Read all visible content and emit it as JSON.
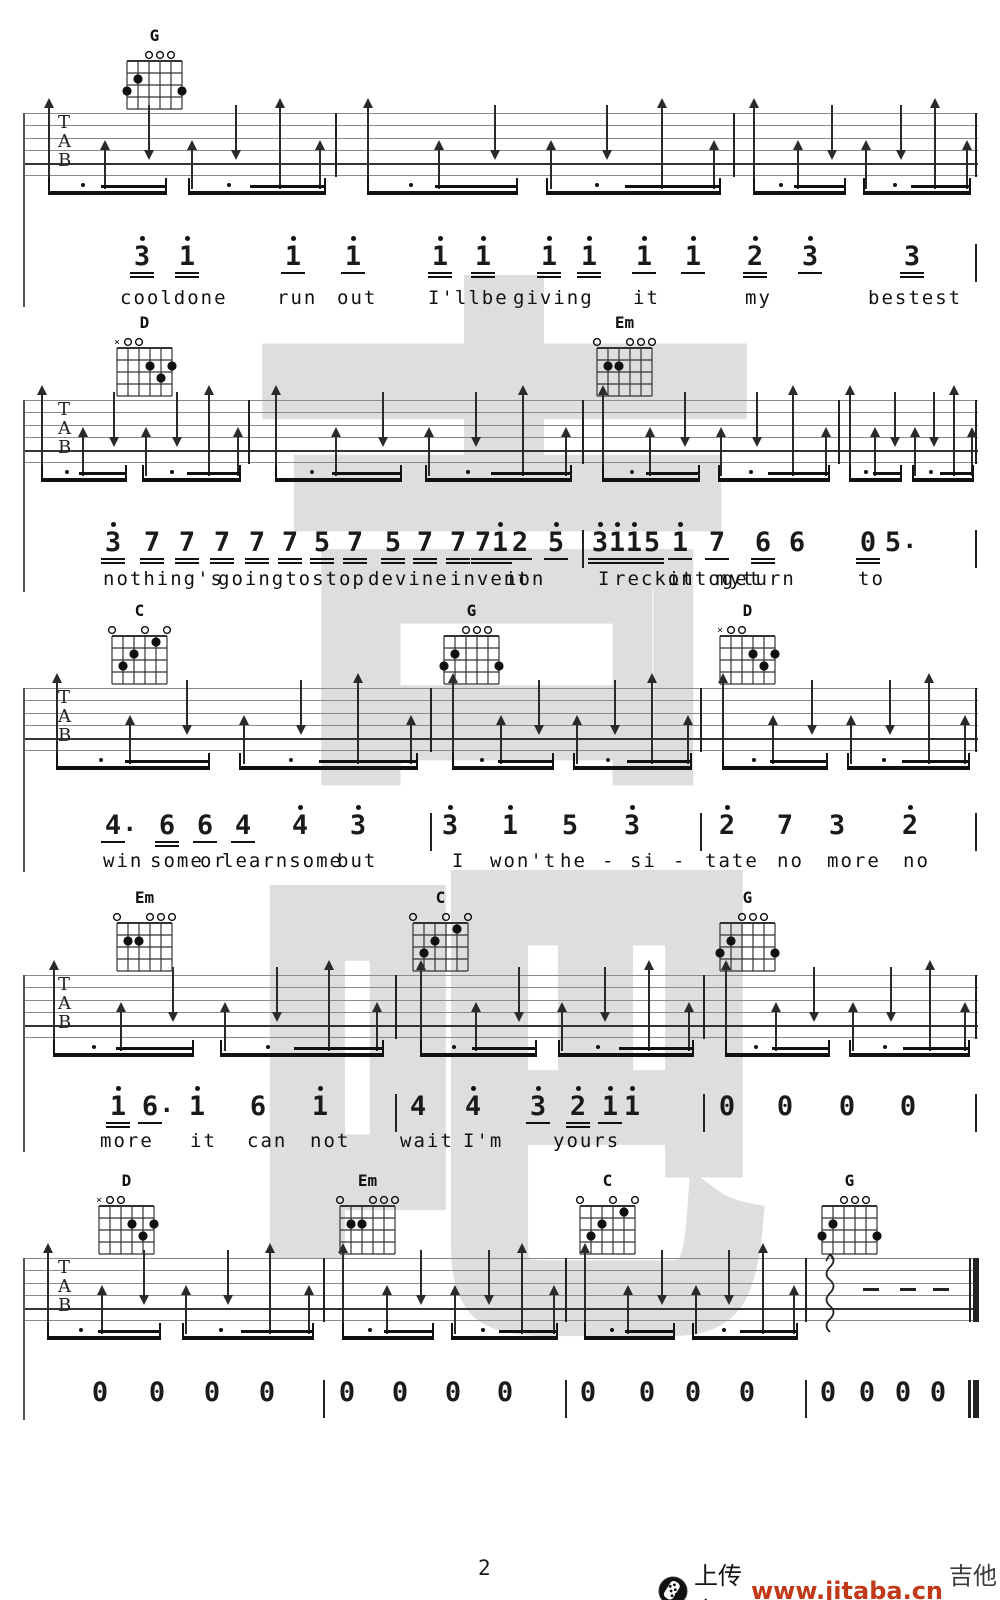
{
  "footer": {
    "page_number": "2",
    "upload_text": "上传自",
    "site_url": "www.jitaba.cn",
    "site_name": "吉他吧",
    "url_color": "#c2391a"
  },
  "watermark": {
    "chars": [
      "吉",
      "吧"
    ],
    "color": "#d6d6d6"
  },
  "tab_letters": [
    "T",
    "A",
    "B"
  ],
  "staff": {
    "left": 23,
    "right": 978,
    "line_gap": 12.4,
    "lines": 6,
    "height": 62
  },
  "strum_pattern": [
    {
      "t": "U",
      "f": 0.08
    },
    {
      "t": "u",
      "f": 0.26
    },
    {
      "t": "d",
      "f": 0.4
    },
    {
      "t": "u",
      "f": 0.54
    },
    {
      "t": "d",
      "f": 0.68
    },
    {
      "t": "U",
      "f": 0.82
    },
    {
      "t": "u",
      "f": 0.95
    }
  ],
  "beam_groups": [
    [
      0.08,
      0.46
    ],
    [
      0.53,
      0.97
    ]
  ],
  "chord_library": {
    "G": {
      "muted": [],
      "opens": [
        4,
        3,
        2
      ],
      "dots": [
        [
          5,
          2
        ],
        [
          6,
          3
        ],
        [
          1,
          3
        ]
      ]
    },
    "D": {
      "muted": [
        6
      ],
      "opens": [
        5,
        4
      ],
      "dots": [
        [
          3,
          2
        ],
        [
          1,
          2
        ],
        [
          2,
          3
        ]
      ]
    },
    "Em": {
      "muted": [],
      "opens": [
        6,
        3,
        2,
        1
      ],
      "dots": [
        [
          5,
          2
        ],
        [
          4,
          2
        ]
      ]
    },
    "C": {
      "muted": [],
      "opens": [
        6,
        3,
        1
      ],
      "dots": [
        [
          2,
          1
        ],
        [
          4,
          2
        ],
        [
          5,
          3
        ]
      ]
    }
  },
  "systems": [
    {
      "staff_top": 113,
      "bars": [
        335,
        733
      ],
      "end": "single",
      "left_line_bottom": 307,
      "chords": [
        {
          "name": "G",
          "x": 155
        }
      ],
      "melody_y": 246,
      "lyrics_y": 287,
      "melody": [
        {
          "x": 142,
          "n": "3",
          "hi": 1,
          "u": 2
        },
        {
          "x": 187,
          "n": "1",
          "hi": 1,
          "u": 2
        },
        {
          "x": 293,
          "n": "1",
          "hi": 1,
          "u": 1
        },
        {
          "x": 353,
          "n": "1",
          "hi": 1,
          "u": 1
        },
        {
          "x": 440,
          "n": "1",
          "hi": 1,
          "u": 2
        },
        {
          "x": 483,
          "n": "1",
          "hi": 1,
          "u": 2
        },
        {
          "x": 549,
          "n": "1",
          "hi": 1,
          "u": 2
        },
        {
          "x": 589,
          "n": "1",
          "hi": 1,
          "u": 2
        },
        {
          "x": 644,
          "n": "1",
          "hi": 1,
          "u": 1
        },
        {
          "x": 693,
          "n": "1",
          "hi": 1,
          "u": 1
        },
        {
          "x": 755,
          "n": "2",
          "hi": 1,
          "u": 2
        },
        {
          "x": 810,
          "n": "3",
          "hi": 1,
          "u": 1
        },
        {
          "x": 912,
          "n": "3",
          "hi": 0,
          "u": 2
        },
        {
          "x": 975,
          "bar": 1
        }
      ],
      "lyrics": [
        {
          "t": "cooldone",
          "x": 120
        },
        {
          "t": "run",
          "x": 277
        },
        {
          "t": "out",
          "x": 337
        },
        {
          "t": "I'llbe",
          "x": 428
        },
        {
          "t": "giving",
          "x": 513
        },
        {
          "t": "it",
          "x": 633
        },
        {
          "t": "my",
          "x": 745
        },
        {
          "t": "bestest",
          "x": 868
        }
      ]
    },
    {
      "staff_top": 400,
      "bars": [
        248,
        582,
        838
      ],
      "end": "single",
      "left_line_bottom": 592,
      "chords": [
        {
          "name": "D",
          "x": 145
        },
        {
          "name": "Em",
          "x": 625
        }
      ],
      "melody_y": 532,
      "lyrics_y": 568,
      "melody": [
        {
          "x": 113,
          "n": "3",
          "hi": 1,
          "u": 2
        },
        {
          "x": 152,
          "n": "7",
          "u": 2
        },
        {
          "x": 187,
          "n": "7",
          "u": 2
        },
        {
          "x": 222,
          "n": "7",
          "u": 2
        },
        {
          "x": 257,
          "n": "7",
          "u": 2
        },
        {
          "x": 290,
          "n": "7",
          "u": 2
        },
        {
          "x": 322,
          "n": "5",
          "u": 2
        },
        {
          "x": 355,
          "n": "7",
          "u": 2
        },
        {
          "x": 393,
          "n": "5",
          "u": 2
        },
        {
          "x": 425,
          "n": "7",
          "u": 2
        },
        {
          "x": 458,
          "n": "7",
          "u": 2
        },
        {
          "x": 483,
          "n": "7",
          "u": 2
        },
        {
          "x": 500,
          "n": "1",
          "hi": 1,
          "u": 2
        },
        {
          "x": 520,
          "n": "2",
          "u": 1
        },
        {
          "x": 556,
          "n": "5",
          "hi": 1,
          "u": 1
        },
        {
          "x": 582,
          "bar": 1
        },
        {
          "x": 600,
          "n": "3",
          "hi": 1,
          "u": 2
        },
        {
          "x": 617,
          "n": "1",
          "hi": 1,
          "u": 2
        },
        {
          "x": 634,
          "n": "1",
          "hi": 1,
          "u": 2
        },
        {
          "x": 652,
          "n": "5",
          "u": 2
        },
        {
          "x": 680,
          "n": "1",
          "hi": 1,
          "u": 1
        },
        {
          "x": 717,
          "n": "7",
          "u": 1
        },
        {
          "x": 763,
          "n": "6",
          "u": 2
        },
        {
          "x": 797,
          "n": "6",
          "u": 0
        },
        {
          "x": 868,
          "n": "0",
          "u": 2
        },
        {
          "x": 893,
          "n": "5",
          "aug": 1,
          "u": 0
        },
        {
          "x": 975,
          "bar": 1
        }
      ],
      "lyrics": [
        {
          "t": "nothing's",
          "x": 103
        },
        {
          "t": "goingtostop",
          "x": 218
        },
        {
          "t": "devine",
          "x": 368
        },
        {
          "t": "invent",
          "x": 450
        },
        {
          "t": "ion",
          "x": 505
        },
        {
          "t": "I",
          "x": 598
        },
        {
          "t": "reckon",
          "x": 614
        },
        {
          "t": "ittoget",
          "x": 668
        },
        {
          "t": "my",
          "x": 716
        },
        {
          "t": "turn",
          "x": 742
        },
        {
          "t": "to",
          "x": 858
        }
      ]
    },
    {
      "staff_top": 688,
      "bars": [
        430,
        700
      ],
      "end": "single",
      "left_line_bottom": 872,
      "chords": [
        {
          "name": "C",
          "x": 140
        },
        {
          "name": "G",
          "x": 472
        },
        {
          "name": "D",
          "x": 748
        }
      ],
      "melody_y": 815,
      "lyrics_y": 850,
      "melody": [
        {
          "x": 113,
          "n": "4",
          "aug": 1,
          "u": 1
        },
        {
          "x": 167,
          "n": "6",
          "u": 2
        },
        {
          "x": 205,
          "n": "6",
          "u": 1
        },
        {
          "x": 243,
          "n": "4",
          "u": 1
        },
        {
          "x": 300,
          "n": "4",
          "hi": 1
        },
        {
          "x": 358,
          "n": "3",
          "hi": 1
        },
        {
          "x": 430,
          "bar": 1
        },
        {
          "x": 450,
          "n": "3",
          "hi": 1
        },
        {
          "x": 510,
          "n": "1",
          "hi": 1
        },
        {
          "x": 570,
          "n": "5"
        },
        {
          "x": 632,
          "n": "3",
          "hi": 1
        },
        {
          "x": 700,
          "bar": 1
        },
        {
          "x": 727,
          "n": "2",
          "hi": 1
        },
        {
          "x": 785,
          "n": "7"
        },
        {
          "x": 837,
          "n": "3"
        },
        {
          "x": 910,
          "n": "2",
          "hi": 1
        },
        {
          "x": 975,
          "bar": 1
        }
      ],
      "lyrics": [
        {
          "t": "win",
          "x": 103
        },
        {
          "t": "some",
          "x": 150
        },
        {
          "t": "or",
          "x": 200
        },
        {
          "t": "learnsome",
          "x": 222
        },
        {
          "t": "but",
          "x": 337
        },
        {
          "t": "I",
          "x": 452
        },
        {
          "t": "won't",
          "x": 490
        },
        {
          "t": "he",
          "x": 560
        },
        {
          "t": "-",
          "x": 602
        },
        {
          "t": "si",
          "x": 630
        },
        {
          "t": "-",
          "x": 673
        },
        {
          "t": "tate",
          "x": 705
        },
        {
          "t": "no",
          "x": 777
        },
        {
          "t": "more",
          "x": 827
        },
        {
          "t": "no",
          "x": 903
        }
      ]
    },
    {
      "staff_top": 975,
      "bars": [
        395,
        703
      ],
      "end": "single",
      "left_line_bottom": 1152,
      "chords": [
        {
          "name": "Em",
          "x": 145
        },
        {
          "name": "C",
          "x": 441
        },
        {
          "name": "G",
          "x": 748
        }
      ],
      "melody_y": 1096,
      "lyrics_y": 1130,
      "melody": [
        {
          "x": 118,
          "n": "1",
          "hi": 1,
          "u": 2
        },
        {
          "x": 150,
          "n": "6",
          "aug": 1,
          "u": 1
        },
        {
          "x": 197,
          "n": "1",
          "hi": 1
        },
        {
          "x": 258,
          "n": "6"
        },
        {
          "x": 320,
          "n": "1",
          "hi": 1
        },
        {
          "x": 395,
          "bar": 1
        },
        {
          "x": 418,
          "n": "4"
        },
        {
          "x": 473,
          "n": "4",
          "hi": 1
        },
        {
          "x": 538,
          "n": "3",
          "hi": 1,
          "u": 1
        },
        {
          "x": 578,
          "n": "2",
          "hi": 1,
          "u": 2
        },
        {
          "x": 610,
          "n": "1",
          "hi": 1,
          "u": 1
        },
        {
          "x": 632,
          "n": "1",
          "hi": 1
        },
        {
          "x": 703,
          "bar": 1
        },
        {
          "x": 727,
          "n": "0"
        },
        {
          "x": 785,
          "n": "0"
        },
        {
          "x": 847,
          "n": "0"
        },
        {
          "x": 908,
          "n": "0"
        },
        {
          "x": 975,
          "bar": 1
        }
      ],
      "lyrics": [
        {
          "t": "more",
          "x": 100
        },
        {
          "t": "it",
          "x": 190
        },
        {
          "t": "can",
          "x": 247
        },
        {
          "t": "not",
          "x": 310
        },
        {
          "t": "wait",
          "x": 400
        },
        {
          "t": "I'm",
          "x": 463
        },
        {
          "t": "yours",
          "x": 553
        }
      ]
    },
    {
      "staff_top": 1258,
      "bars": [
        323,
        565,
        805
      ],
      "end": "double",
      "left_line_bottom": 1420,
      "chords": [
        {
          "name": "D",
          "x": 127
        },
        {
          "name": "Em",
          "x": 368
        },
        {
          "name": "C",
          "x": 608
        },
        {
          "name": "G",
          "x": 850
        }
      ],
      "melody_y": 1382,
      "lyrics_y": 0,
      "skip_last_measure": true,
      "squiggle_x": 829,
      "rest_dashes": [
        863,
        900,
        933
      ],
      "melody": [
        {
          "x": 100,
          "n": "0"
        },
        {
          "x": 157,
          "n": "0"
        },
        {
          "x": 212,
          "n": "0"
        },
        {
          "x": 267,
          "n": "0"
        },
        {
          "x": 323,
          "bar": 1
        },
        {
          "x": 347,
          "n": "0"
        },
        {
          "x": 400,
          "n": "0"
        },
        {
          "x": 453,
          "n": "0"
        },
        {
          "x": 505,
          "n": "0"
        },
        {
          "x": 565,
          "bar": 1
        },
        {
          "x": 588,
          "n": "0"
        },
        {
          "x": 647,
          "n": "0"
        },
        {
          "x": 693,
          "n": "0"
        },
        {
          "x": 747,
          "n": "0"
        },
        {
          "x": 805,
          "bar": 1
        },
        {
          "x": 828,
          "n": "0"
        },
        {
          "x": 867,
          "n": "0"
        },
        {
          "x": 903,
          "n": "0"
        },
        {
          "x": 938,
          "n": "0"
        },
        {
          "x": 968,
          "bar": 2
        }
      ],
      "lyrics": []
    }
  ]
}
